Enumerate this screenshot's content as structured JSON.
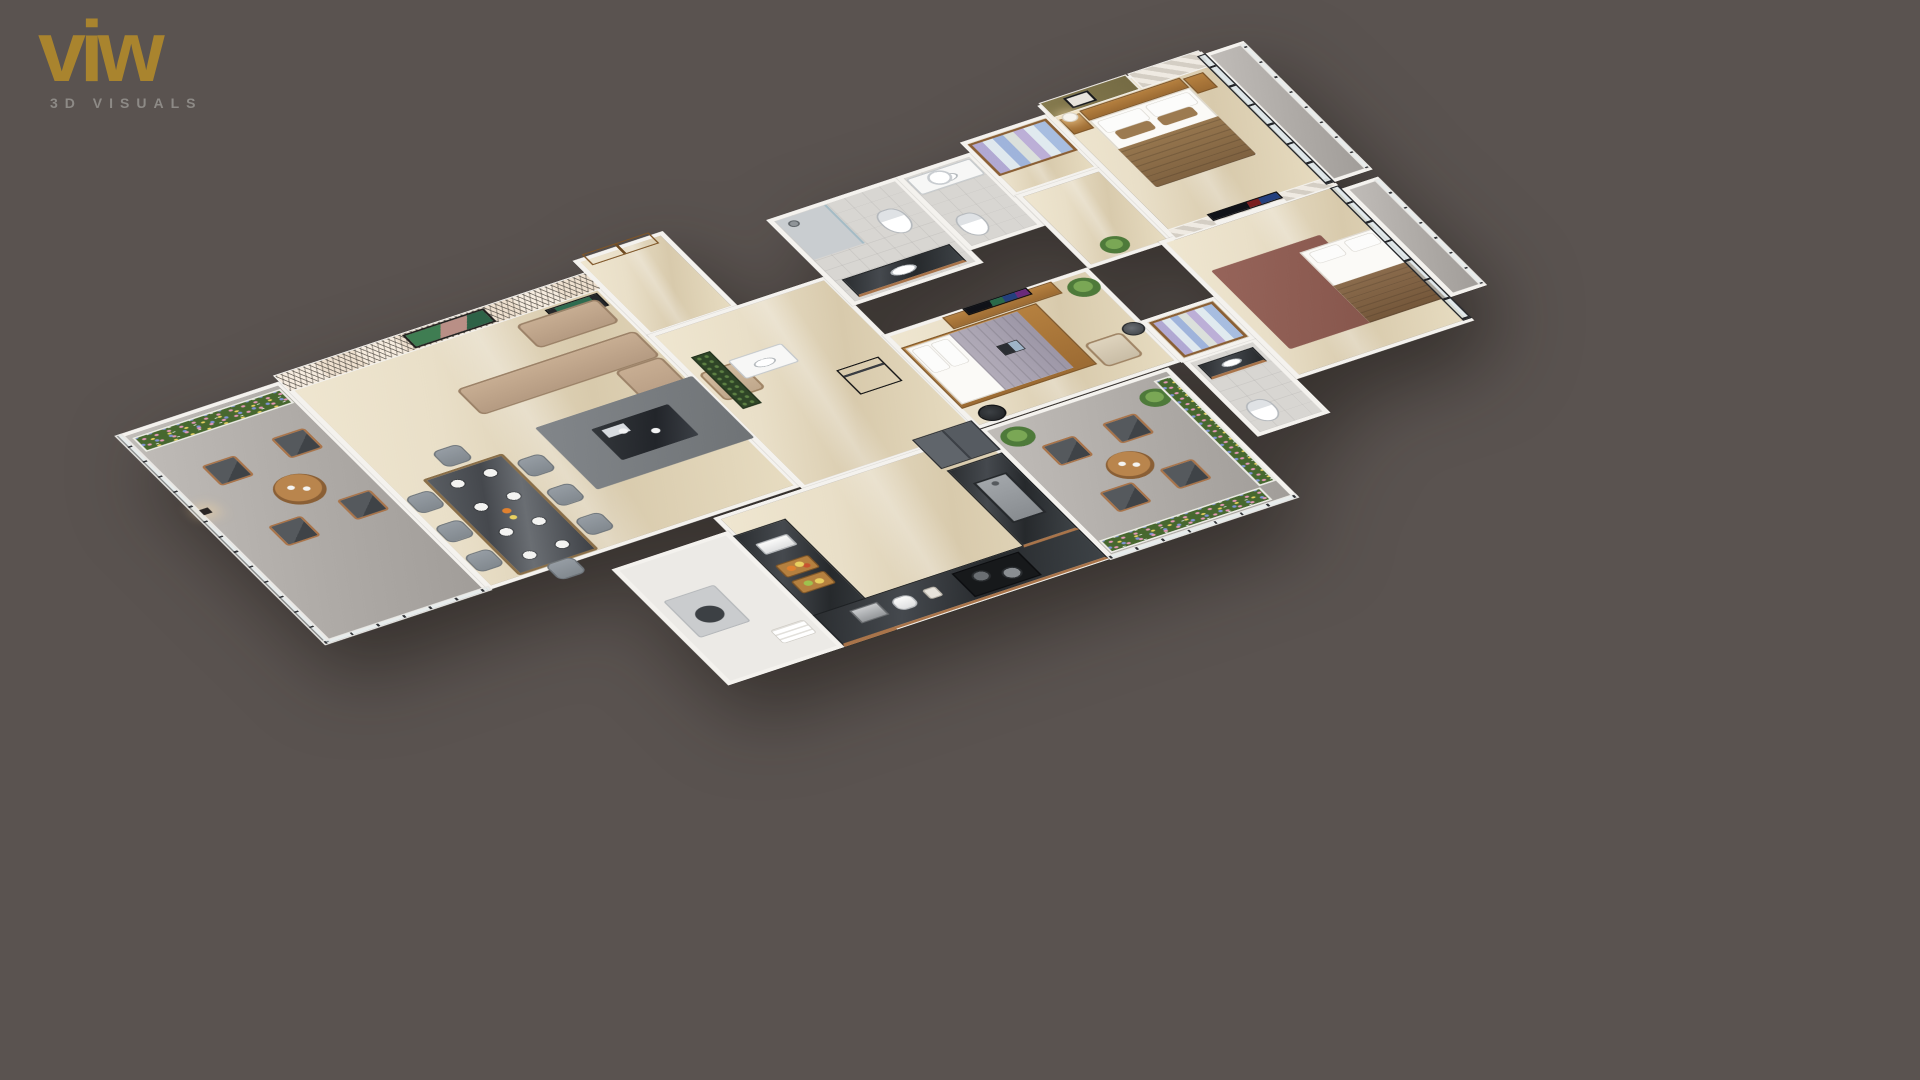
{
  "logo": {
    "brand": "viw",
    "tagline": "3D VISUALS"
  },
  "palette": {
    "bg": "#5a5350",
    "gold": "#a9842e",
    "tagline": "#8d8a86",
    "wall": "#f4f2ee",
    "floorCream": "#e9dfc8",
    "floorGray": "#b4b0ac",
    "wallGray": "#96938f",
    "oliveAccent": "#7e744a",
    "wood": "#a9744a",
    "sofaBeige": "#bba188",
    "charcoalCushion": "#4b4f53",
    "counterMarble": "#2b2e31",
    "rugGray": "#797d80",
    "bedTanBlanket": "#8a6b46",
    "bedLavender": "#a7a1ae",
    "rugMaroon": "#8d5a50",
    "applianceSlate": "#565b61",
    "leafGreen": "#4e7a3a",
    "flowerPink": "#e698b8",
    "flowerYellow": "#e8d060",
    "flowerBlue": "#8093d6",
    "fruitOrange": "#e0812f",
    "glassTint": "#cfe0e6"
  },
  "scene": {
    "rooms": [
      "left balcony",
      "living room",
      "dining area",
      "foyer",
      "kitchen",
      "utility room",
      "hallway",
      "powder room",
      "bathroom 1",
      "bathroom 2",
      "master dressing",
      "master bedroom",
      "master balcony",
      "bedroom 2",
      "ensuite bathroom",
      "walk-in wardrobe",
      "bedroom 3",
      "rear balcony"
    ]
  }
}
